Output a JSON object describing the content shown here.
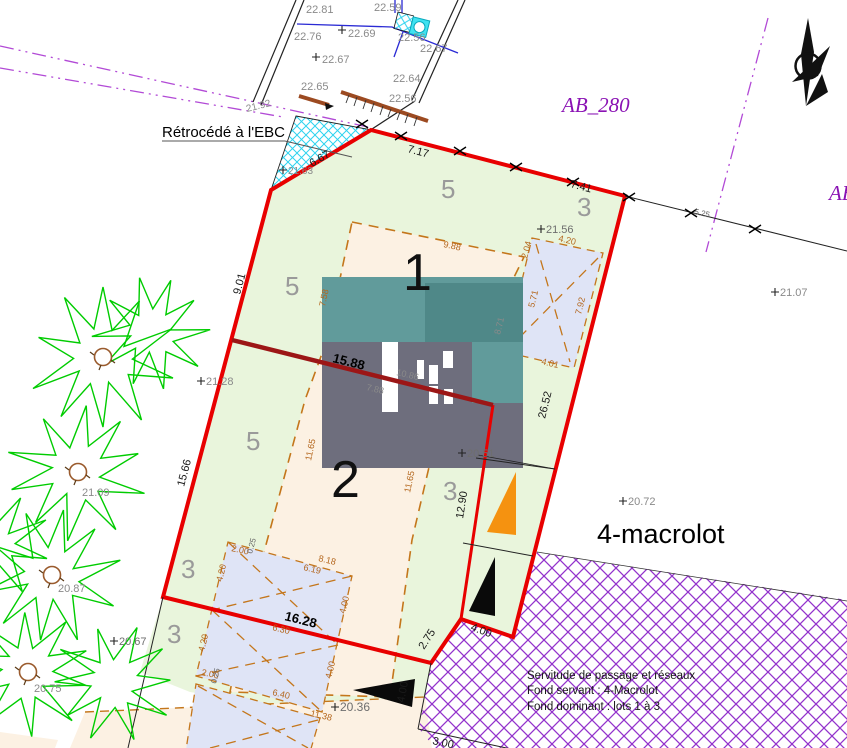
{
  "labels": {
    "retrocede": "Rétrocédé à l'EBC",
    "parcel_ab280": "AB_280",
    "parcel_adjacent_partial": "AB",
    "macrolot": "4-macrolot",
    "servitude": {
      "line1": "Servitude de passage et réseaux",
      "line2": "Fond servant : 4-Macrolot",
      "line3": "Fond dominant : lots 1 à 3"
    }
  },
  "lots": {
    "lot1": "1",
    "lot2": "2"
  },
  "zones": {
    "z5_top": "5",
    "z3_top": "3",
    "z5_mid": "5",
    "z5_low": "5",
    "z3_mid": "3",
    "z3_left_upper": "3",
    "z3_left_lower": "3"
  },
  "elevations": {
    "e22_81": "22.81",
    "e22_59": "22.59",
    "e22_76": "22.76",
    "e22_69": "22.69",
    "e22_56_a": "22.56",
    "e22_67_a": "22.67",
    "e22_67_b": "22.67",
    "e22_64": "22.64",
    "e22_65": "22.65",
    "e22_56_b": "22.56",
    "e21_92": "21.92",
    "e21_63": "21.63",
    "e21_56": "21.56",
    "e21_28": "21.28",
    "e21_07": "21.07",
    "e21_09": "21.09",
    "e20_87": "20.87",
    "e20_75": "20.75",
    "e20_67": "20.67",
    "e20_72": "20.72",
    "e20_51": "20.51",
    "e20_36": "20.36"
  },
  "dims": {
    "d7_17": "7.17",
    "d7_41": "7.41",
    "d6_67": "6.67",
    "d9_01": "9.01",
    "d15_66": "15.66",
    "d26_52": "26.52",
    "d12_90": "12.90",
    "d2_75": "2.75",
    "d4_00_a": "4.00",
    "d4_00_b": "4.00",
    "d3_00": "3.00",
    "d16_28": "16.28",
    "d15_88": "15.88",
    "d5_25": "5.25",
    "d9_88": "9.88",
    "d7_58": "7.58",
    "d11_65_a": "11.65",
    "d11_65_b": "11.65",
    "d4_20_a": "4.20",
    "d2_04": "2.04",
    "d5_71": "5.71",
    "d7_92": "7.92",
    "d4_01": "4.01",
    "d8_71": "8.71",
    "d7_88": "7.88",
    "d10_86": "10.86",
    "d2_00_a": "2.00",
    "d0_25_a": "0.25",
    "d8_18": "8.18",
    "d6_19": "6.19",
    "d4_20_b": "4.20",
    "d4_20_c": "4.20",
    "d4_00_c": "4.00",
    "d4_00_d": "4.00",
    "d6_30": "6.30",
    "d6_40": "6.40",
    "d11_38": "11.38",
    "d2_00_b": "2.00",
    "d0_25_b": "0.25"
  },
  "colors": {
    "boundary_red": "#e80000",
    "divider_dark_red": "#9c1616",
    "parcel_green_fill": "#e9f5dc",
    "buildable_cream": "#fcf1e3",
    "parking_lavender": "#dfe4f6",
    "building_teal": "#619b9b",
    "building_teal_dark": "#4f8888",
    "building_gray": "#6e6e7d",
    "tree_green": "#00cc00",
    "servitude_purple": "#9333cc",
    "ebc_cyan": "#2ed3ef",
    "dash_orange": "#c4761b",
    "network_blue": "#2a2ad4",
    "wall_brown": "#9c4a21",
    "accent_orange_triangle": "#f59210",
    "parcel_label_purple": "#8a12b4"
  }
}
